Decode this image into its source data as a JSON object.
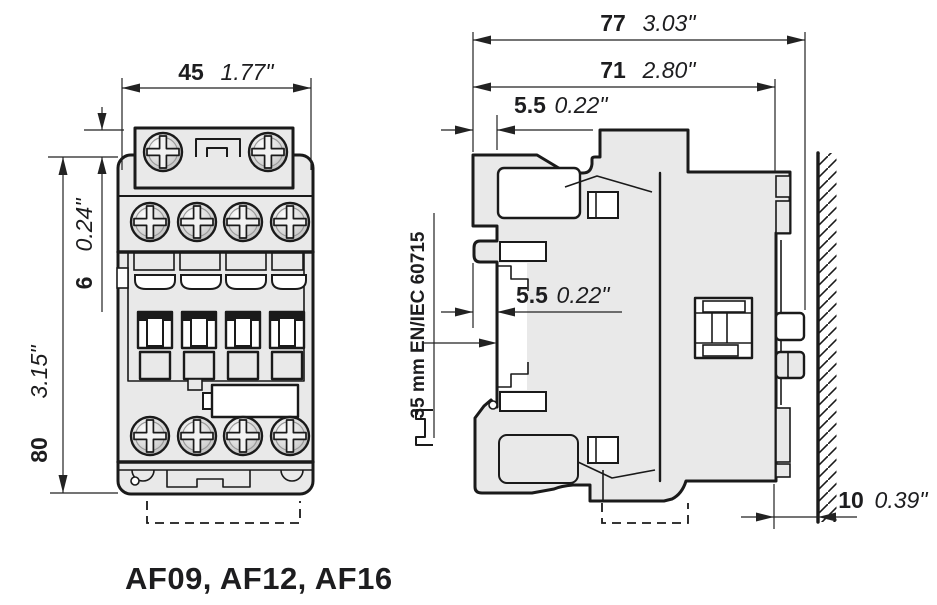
{
  "caption": "AF09, AF12, AF16",
  "colors": {
    "body_fill": "#e9e9e9",
    "line": "#1a1a1a",
    "dim": "#222222",
    "white": "#ffffff",
    "text": "#1d1d1f"
  },
  "front_view": {
    "width": {
      "mm": "45",
      "inch": "1.77\""
    },
    "top_offset": {
      "mm": "6",
      "inch": "0.24\""
    },
    "height": {
      "mm": "80",
      "inch": "3.15\""
    }
  },
  "side_view": {
    "total_depth": {
      "mm": "77",
      "inch": "3.03\""
    },
    "body_depth": {
      "mm": "71",
      "inch": "2.80\""
    },
    "top_offset": {
      "mm": "5.5",
      "inch": "0.22\""
    },
    "rail_offset": {
      "mm": "5.5",
      "inch": "0.22\""
    },
    "wall_gap": {
      "mm": "10",
      "inch": "0.39\""
    },
    "rail_standard": "35 mm EN/IEC 60715"
  }
}
